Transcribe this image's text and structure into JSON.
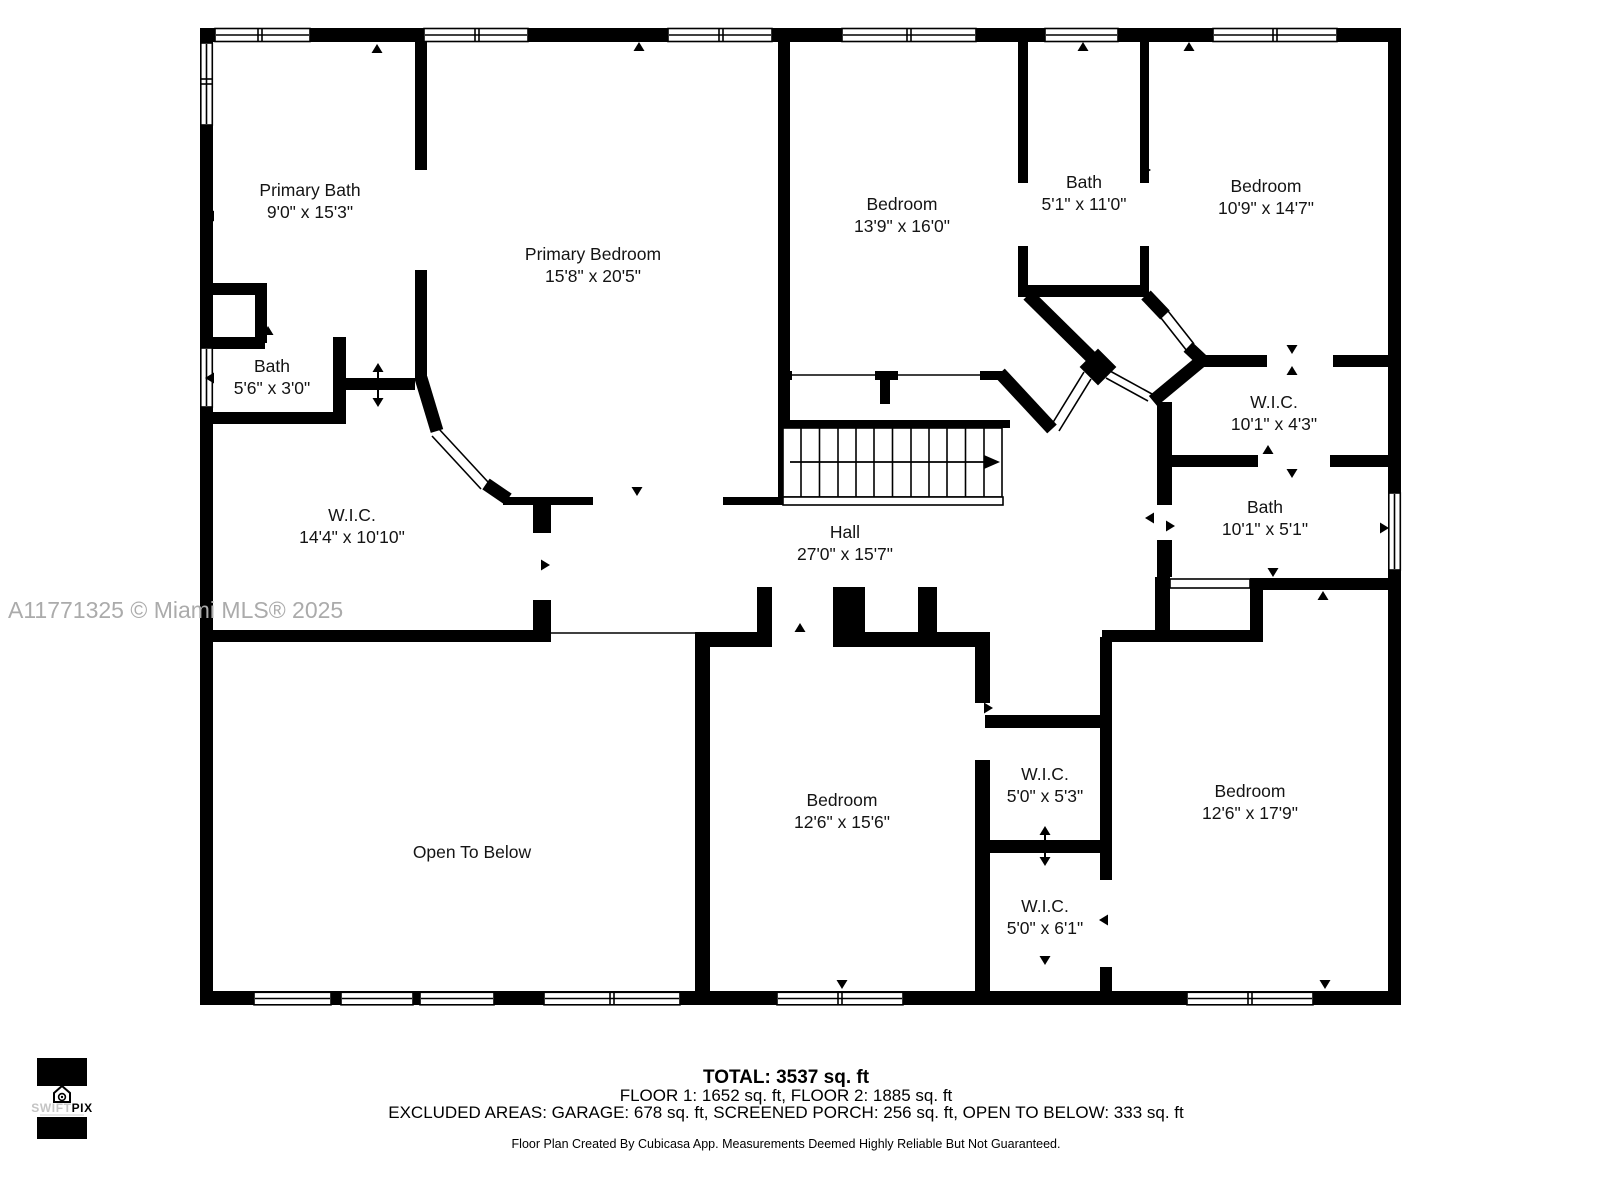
{
  "watermark": "A11771325 © Miami MLS® 2025",
  "rooms": [
    {
      "name": "Primary Bath",
      "dims": "9'0\" x 15'3\""
    },
    {
      "name": "Primary Bedroom",
      "dims": "15'8\" x 20'5\""
    },
    {
      "name": "Bedroom",
      "dims": "13'9\" x 16'0\""
    },
    {
      "name": "Bath",
      "dims": "5'1\" x 11'0\""
    },
    {
      "name": "Bedroom",
      "dims": "10'9\" x 14'7\""
    },
    {
      "name": "Bath",
      "dims": "5'6\" x 3'0\""
    },
    {
      "name": "W.I.C.",
      "dims": "14'4\" x 10'10\""
    },
    {
      "name": "Hall",
      "dims": "27'0\" x 15'7\""
    },
    {
      "name": "W.I.C.",
      "dims": "10'1\" x 4'3\""
    },
    {
      "name": "Bath",
      "dims": "10'1\" x 5'1\""
    },
    {
      "name": "Open To Below",
      "dims": ""
    },
    {
      "name": "Bedroom",
      "dims": "12'6\" x 15'6\""
    },
    {
      "name": "W.I.C.",
      "dims": "5'0\" x 5'3\""
    },
    {
      "name": "W.I.C.",
      "dims": "5'0\" x 6'1\""
    },
    {
      "name": "Bedroom",
      "dims": "12'6\" x 17'9\""
    }
  ],
  "summary": {
    "total": "TOTAL: 3537 sq. ft",
    "floors": "FLOOR 1: 1652 sq. ft, FLOOR 2: 1885 sq. ft",
    "excluded": "EXCLUDED AREAS: GARAGE: 678 sq. ft, SCREENED PORCH: 256 sq. ft, OPEN TO BELOW: 333 sq. ft",
    "disclaimer": "Floor Plan Created By Cubicasa App. Measurements Deemed Highly Reliable But Not Guaranteed."
  },
  "logo": {
    "swift": "SWIFT",
    "pix": "PIX"
  }
}
